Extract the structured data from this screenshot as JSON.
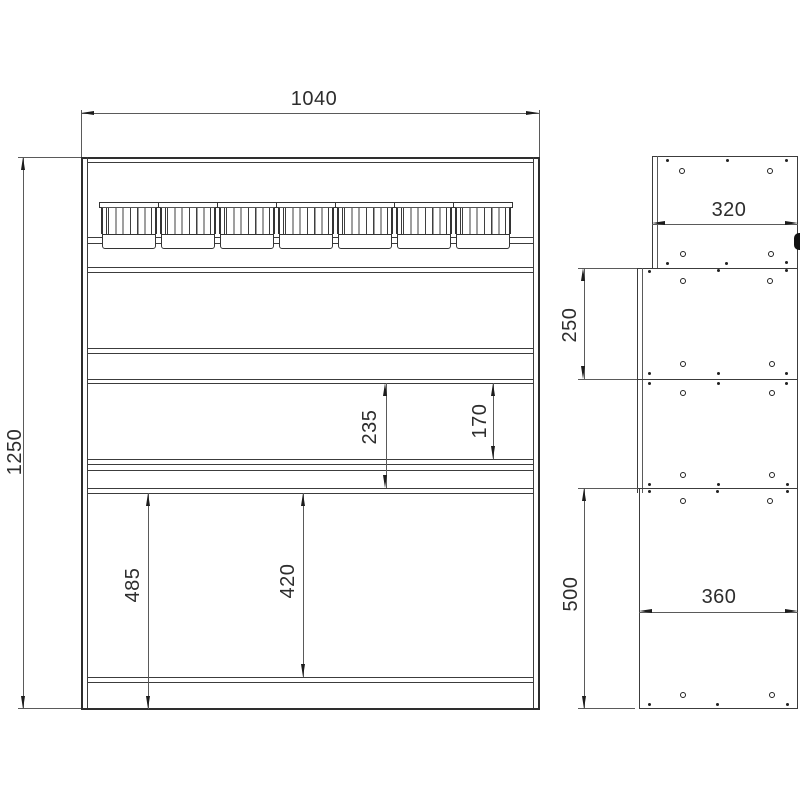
{
  "front_view": {
    "width": "1040",
    "height": "1250",
    "shelf_pitch": "235",
    "shelf_opening": "170",
    "bottom_section_height": "485",
    "bottom_opening": "420",
    "bin_count": 7
  },
  "side_view": {
    "top_panel_depth": "320",
    "upper_section_height": "250",
    "lower_section_height": "500",
    "base_depth": "360"
  },
  "colors": {
    "line": "#3c3c3c",
    "background": "#ffffff"
  }
}
